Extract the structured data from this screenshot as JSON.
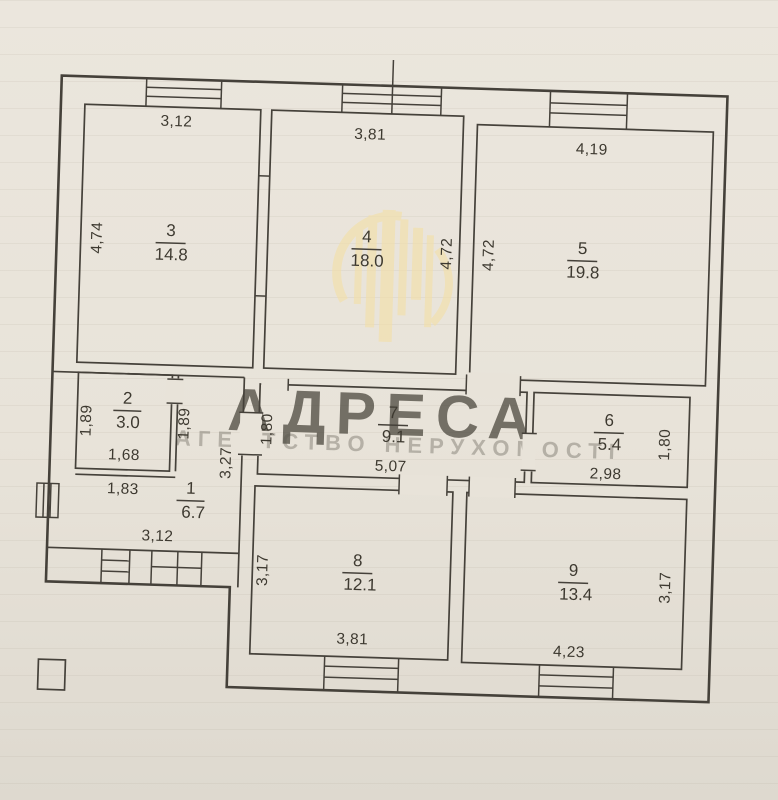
{
  "watermark": {
    "title": "АДРЕСА",
    "subtitle": "АГЕНТСТВО НЕРУХОМОСТІ",
    "color": "#f3dfa9"
  },
  "colors": {
    "paper": "#e8e3d9",
    "ink": "#45413a",
    "watermark": "#f3dfa9"
  },
  "rooms": {
    "r1": {
      "number": "1",
      "area": "6.7",
      "dim_top": "1,83",
      "dim_right": "3,27",
      "dim_bottom": "3,12"
    },
    "r2": {
      "number": "2",
      "area": "3.0",
      "dim_left": "1,89",
      "dim_right": "1,89",
      "dim_bottom": "1,68"
    },
    "r3": {
      "number": "3",
      "area": "14.8",
      "dim_top": "3,12",
      "dim_left": "4,74"
    },
    "r4": {
      "number": "4",
      "area": "18.0",
      "dim_top": "3,81",
      "dim_right": "4,72"
    },
    "r5": {
      "number": "5",
      "area": "19.8",
      "dim_top": "4,19",
      "dim_left": "4,72"
    },
    "r6": {
      "number": "6",
      "area": "5.4",
      "dim_bottom": "2,98",
      "dim_right": "1,80"
    },
    "r7": {
      "number": "7",
      "area": "9.1",
      "dim_left": "1,80",
      "dim_bottom": "5,07"
    },
    "r8": {
      "number": "8",
      "area": "12.1",
      "dim_left": "3,17",
      "dim_bottom": "3,81"
    },
    "r9": {
      "number": "9",
      "area": "13.4",
      "dim_bottom": "4,23",
      "dim_right": "3,17"
    }
  }
}
